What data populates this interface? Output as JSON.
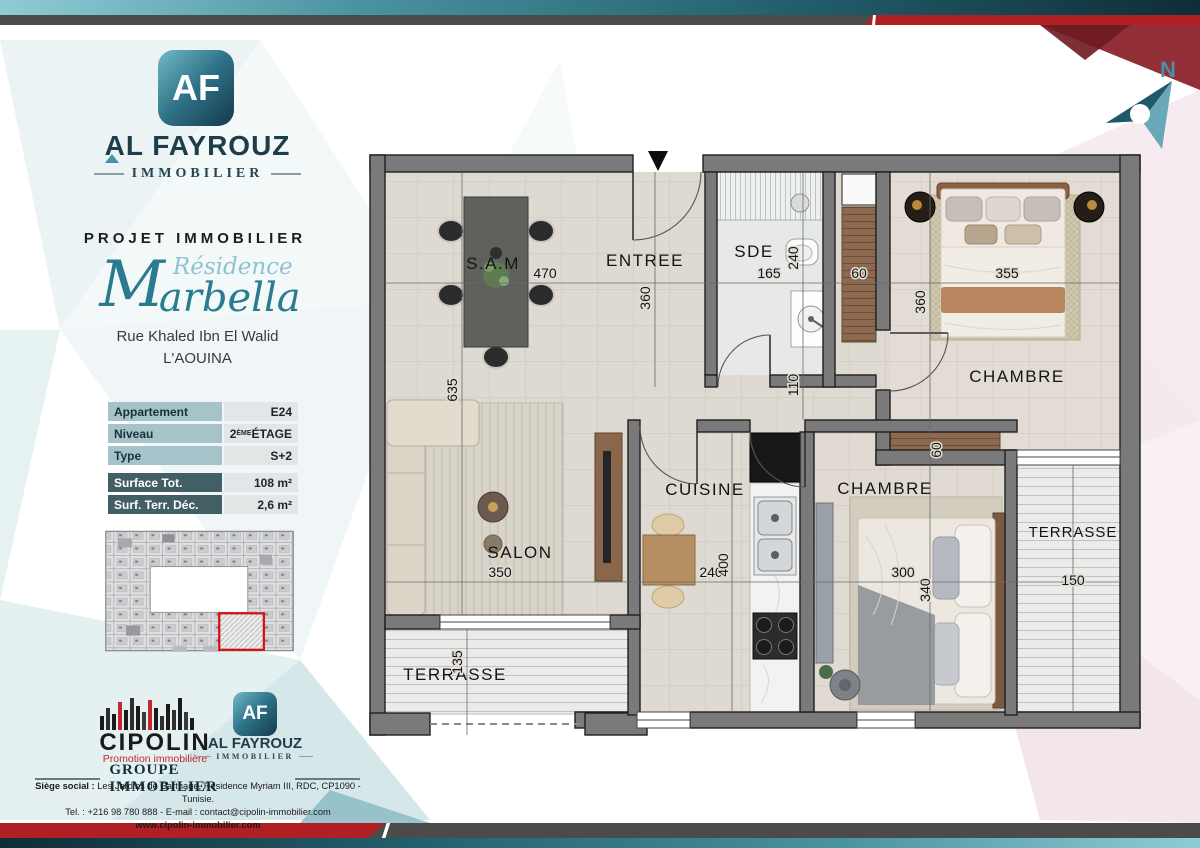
{
  "brand": {
    "monogram": "AF",
    "wordmark": "AL FAYROUZ",
    "wordmark_sub": "IMMOBILIER"
  },
  "project": {
    "kicker": "PROJET IMMOBILIER",
    "script_initial": "M",
    "script_prefix": "Résidence",
    "script_rest": "arbella",
    "address_line1": "Rue Khaled Ibn El Walid",
    "address_line2": "L'AOUINA"
  },
  "details": {
    "rows": [
      {
        "label": "Appartement",
        "value": "E24"
      },
      {
        "label": "Niveau",
        "value_base": "2",
        "value_sup": "ÈME",
        "value_rest": " ÉTAGE"
      },
      {
        "label": "Type",
        "value": "S+2"
      },
      {
        "label": "Surface Tot.",
        "value": "108 m²"
      },
      {
        "label": "Surf. Terr. Déc.",
        "value": "2,6 m²"
      }
    ]
  },
  "floorplan": {
    "north": "N",
    "sam": {
      "label": "S.A.M",
      "dim_w": "470"
    },
    "entree": {
      "label": "ENTREE",
      "dim_h": "360"
    },
    "sde": {
      "label": "SDE",
      "dim_w": "165",
      "dim_h": "240"
    },
    "closet_sde": {
      "dim": "60"
    },
    "chambre1": {
      "label": "CHAMBRE",
      "dim_w": "355",
      "dim_h": "360"
    },
    "hall": {
      "dim": "110"
    },
    "cuisine": {
      "label": "CUISINE",
      "dim_w": "240",
      "dim_h": "400"
    },
    "chambre2": {
      "label": "CHAMBRE",
      "dim_w": "300",
      "dim_h": "340"
    },
    "closet_ch2": {
      "dim": "60"
    },
    "salon": {
      "label": "SALON",
      "dim_w": "350",
      "dim_h": "635"
    },
    "terrasse_sud": {
      "label": "TERRASSE",
      "dim_h": "135"
    },
    "terrasse_est": {
      "label": "TERRASSE",
      "dim_w": "150"
    }
  },
  "footer": {
    "cipolin": {
      "name": "CIPOLIN",
      "tagline": "Promotion immobilière"
    },
    "alfayrouz": {
      "monogram": "AF",
      "name": "AL FAYROUZ",
      "sub": "IMMOBILIER"
    },
    "group_label": "GROUPE IMMOBILIER",
    "address_label": "Siège social :",
    "address_rest": " Les Jardins de Carthage, Résidence Myriam III, RDC, CP1090 - Tunisie.",
    "contact": "Tel. : +216 98 780 888 -  E-mail : contact@cipolin-immobilier.com",
    "website": "www.cipolin-immobilier.com"
  },
  "colors": {
    "teal_dark": "#15394a",
    "teal": "#2a7b90",
    "teal_light": "#8fc2d2",
    "red": "#b01f24",
    "gray_bar": "#4b4b4b",
    "wall": "#7a7a7a",
    "floor": "#ded9d1"
  }
}
